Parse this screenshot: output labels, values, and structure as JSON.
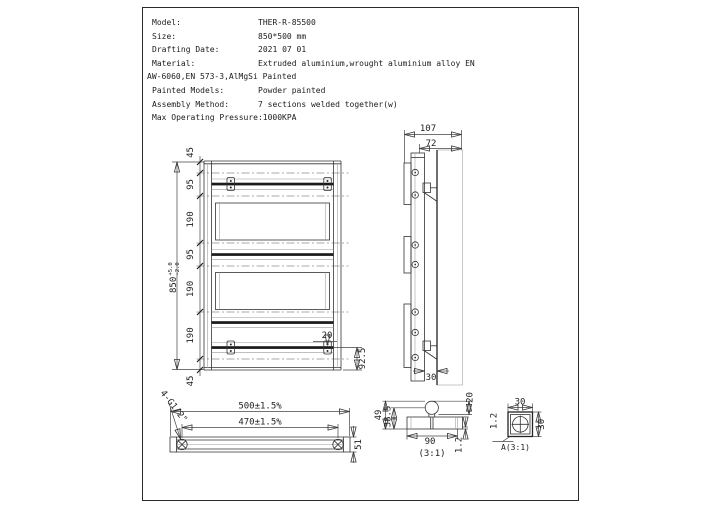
{
  "spec_table": {
    "rows": [
      {
        "label": "Model:",
        "value": "THER-R-85500"
      },
      {
        "label": "Size:",
        "value": "850*500 mm"
      },
      {
        "label": "Drafting Date:",
        "value": "2021 07 01"
      },
      {
        "label": "Material:",
        "value": "Extruded aluminium,wrought aluminium alloy EN"
      },
      {
        "label": "Painted Models:",
        "value": "Powder painted"
      },
      {
        "label": "Assembly Method:",
        "value": "7 sections welded together(w)"
      },
      {
        "label": "Max Operating Pressure:",
        "value": "1000KPA"
      }
    ],
    "material_continuation": "AW-6060,EN 573-3,AlMgSi Painted"
  },
  "front_view": {
    "overall_height": "850",
    "tolerance_upper": "+5.0",
    "tolerance_lower": "-2.0",
    "segments": [
      "45",
      "95",
      "190",
      "95",
      "190",
      "190",
      "45"
    ],
    "bracket_width": "20",
    "bracket_bottom_offset": "92.5"
  },
  "side_view": {
    "total_depth": "107",
    "bracket_depth": "72",
    "wall_gap": "30"
  },
  "bottom_view": {
    "overall_width": "500±1.5%",
    "connection_centers": "470±1.5%",
    "thread_callout": "4-G1/2\"",
    "depth": "51"
  },
  "detail_section": {
    "total_height": "49",
    "tube_center_height": "38.5",
    "panel_width": "90",
    "wall_thickness": "1.2",
    "tube_diameter": "20",
    "scale_label": "(3:1)"
  },
  "detail_a": {
    "width": "30",
    "height": "30",
    "wall_thickness": "1.2",
    "label": "A(3:1)"
  }
}
